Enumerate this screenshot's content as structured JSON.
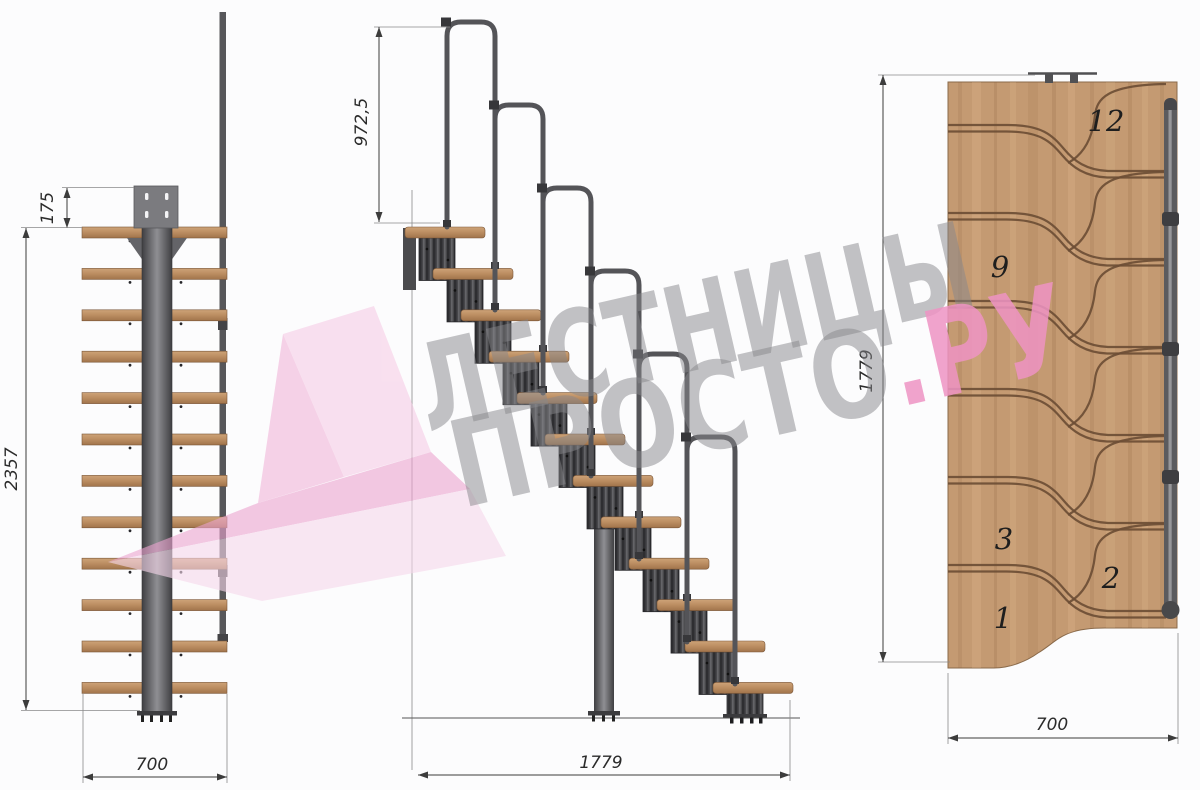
{
  "watermark": {
    "brand_line1": "ЛЕСТНИЦЫ",
    "brand_line2": "ПРОСТО",
    "brand_line2_suffix": ".РУ",
    "gray_color": "#88888c",
    "pink_color": "#ef94c4"
  },
  "front_view": {
    "dim_top_offset": "175",
    "dim_total_height": "2357",
    "dim_width": "700"
  },
  "side_view": {
    "dim_handrail_height": "972,5",
    "dim_total_length": "1779"
  },
  "plan_view": {
    "dim_total_length": "1779",
    "dim_width": "700",
    "step_labels": {
      "s12": "12",
      "s9": "9",
      "s3": "3",
      "s2": "2",
      "s1": "1"
    }
  },
  "colors": {
    "wood_light": "#cda378",
    "wood_dark": "#a1744b",
    "plan_wood": "#c49a72",
    "metal_dark": "#3f3f42",
    "metal_light": "#909094",
    "curve_brown": "#6d4e35",
    "logo_pink": "#eca4d0"
  }
}
